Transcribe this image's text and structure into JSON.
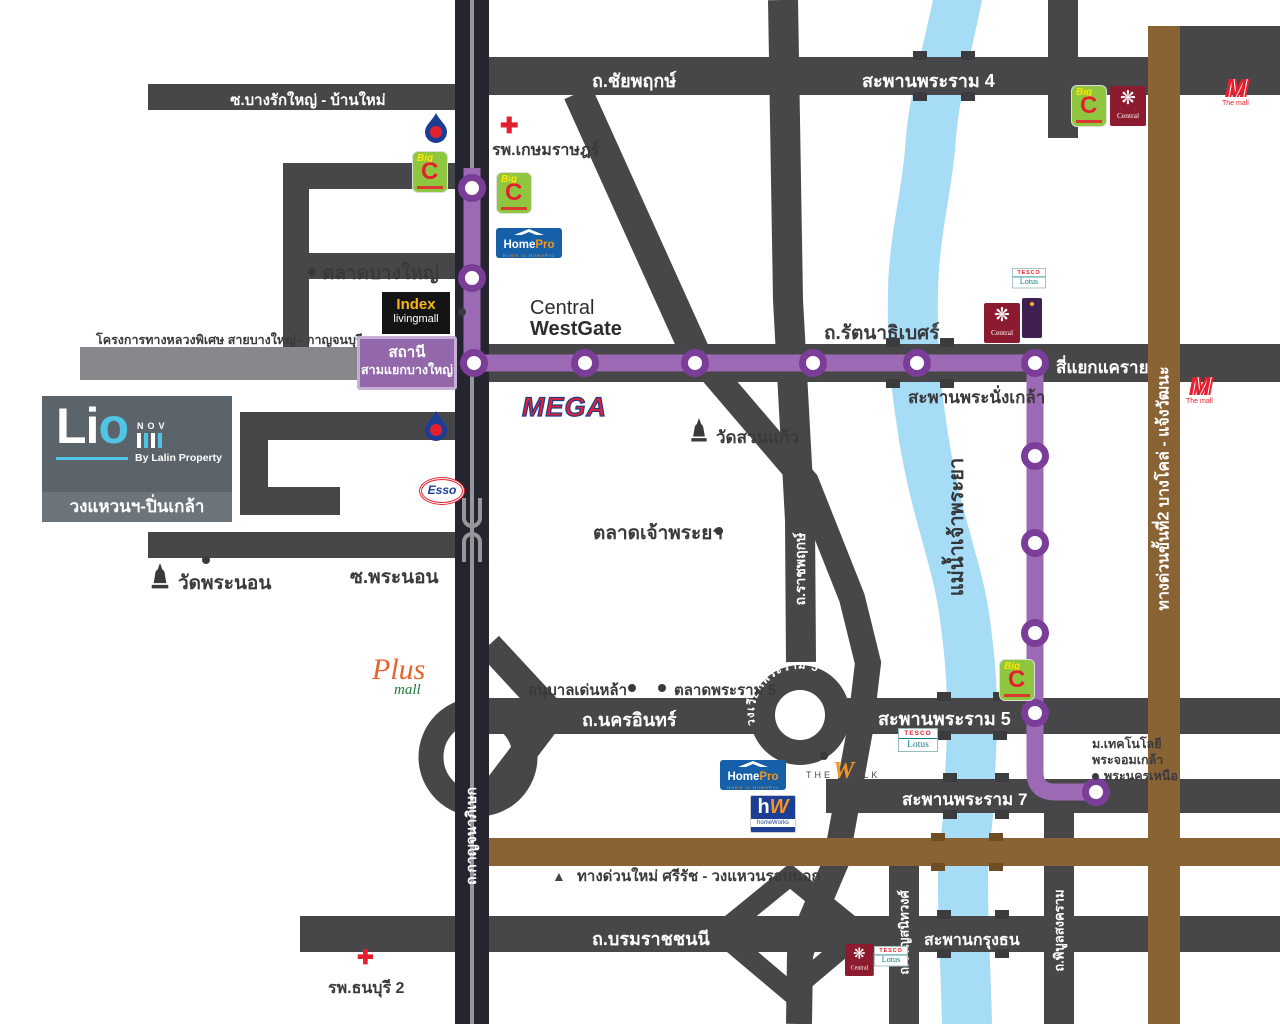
{
  "icons": {
    "dot": "●",
    "triangle_down": "▼",
    "triangle_up": "▲",
    "cross": "✚",
    "flower": "❋"
  },
  "project": {
    "brand_li": "Li",
    "brand_o": "o",
    "series": "NOV",
    "byline": "By Lalin Property",
    "location": "วงแหวนฯ-ปิ่นเกล้า"
  },
  "station": {
    "line1": "สถานี",
    "line2": "สามแยกบางใหญ่"
  },
  "roads": {
    "chaiyaphruek": "ถ.ชัยพฤกษ์",
    "rama4_bridge": "สะพานพระราม 4",
    "bang_rak_yai": "ซ.บางรักใหญ่ - บ้านใหม่",
    "rattanathibet": "ถ.รัตนาธิเบศร์",
    "phra_nangklao_bridge": "สะพานพระนั่งเกล้า",
    "khae_rai": "สี่แยกแคราย",
    "motorway_project": "โครงการทางหลวงพิเศษ สายบางใหญ่ - กาญจนบุรี",
    "kanchanaphisek": "ถ.กาญจนาภิเษก",
    "ratchaphruek": "ถ.ราชพฤกษ์",
    "phra_non_soi": "ซ.พระนอน",
    "nakhon_in": "ถ.นครอินทร์",
    "rama5_roundabout": "วงเวียนพระราม 5",
    "rama5_bridge": "สะพานพระราม 5",
    "rama7_bridge": "สะพานพระราม 7",
    "expressway2": "ทางด่วนขั้นที่2 บางโคล่ - แจ้งวัฒนะ",
    "new_expressway": "ทางด่วนใหม่ ศรีรัช - วงแหวนรอบนอก",
    "borommaratchachonnani": "ถ.บรมราชชนนี",
    "charansanitwong": "ถ.จรัญสนิทวงศ์",
    "krung_thon_bridge": "สะพานกรุงธน",
    "phibunsongkhram": "ถ.พิบูลสงคราม",
    "chao_phraya_river": "แม่น้ำเจ้าพระยา"
  },
  "places": {
    "kasemrad_hospital": "รพ.เกษมราษฎร์",
    "bang_yai_market": "ตลาดบางใหญ่",
    "central_westgate_1": "Central",
    "central_westgate_2": "WestGate",
    "wat_suan_kaew": "วัดสวนแก้ว",
    "chao_phraya_market": "ตลาดเจ้าพระยา",
    "wat_phra_non": "วัดพระนอน",
    "denla_kindergarten": "อนุบาลเด่นหล้า",
    "rama5_market": "ตลาดพระราม 5",
    "kmutnb_line1": "ม.เทคโนโลยี",
    "kmutnb_line2": "พระจอมเกล้า",
    "kmutnb_line3": "พระนครเหนือ",
    "thonburi2_hospital": "รพ.ธนบุรี 2"
  },
  "logos": {
    "bigc": {
      "big": "Big",
      "c": "C"
    },
    "central": {
      "name": "Central"
    },
    "homepro": {
      "home": "Home",
      "pro": "Pro",
      "sub": "Home is HomePro"
    },
    "homeworks": {
      "h": "h",
      "w": "W",
      "sub": "homeWorks"
    },
    "index": {
      "line1": "Index",
      "line2": "livingmall"
    },
    "mega": {
      "name": "MEGA"
    },
    "esso": {
      "name": "Esso"
    },
    "lotus": {
      "tesco": "TESCO",
      "lotus": "Lotus"
    },
    "themall": {
      "m": "M",
      "sub": "The mall"
    },
    "thewalk": {
      "the": "THE",
      "w": "W",
      "alk": "ALK"
    },
    "plusmall": {
      "plus": "Plus",
      "mall": "mall"
    }
  }
}
